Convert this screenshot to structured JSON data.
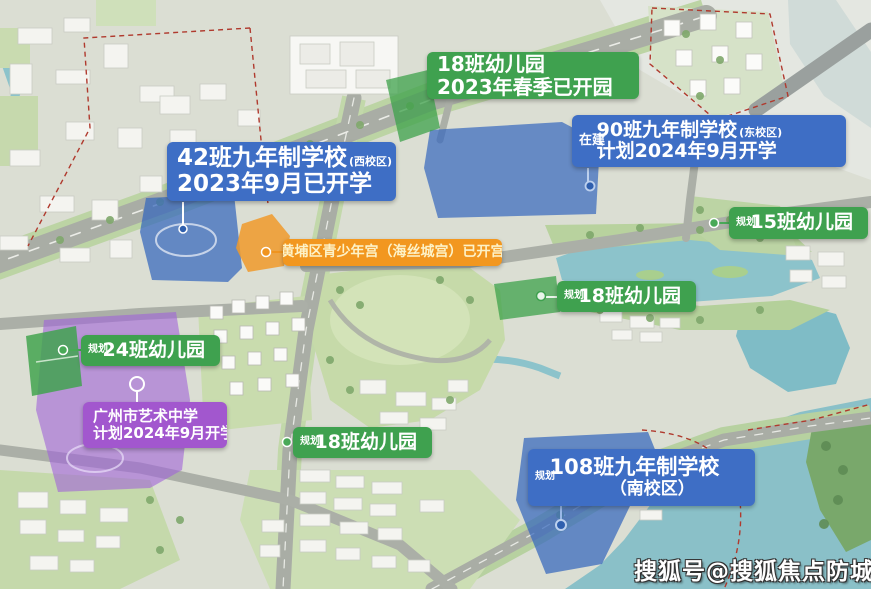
{
  "watermark": "搜狐号@搜狐焦点防城港站",
  "colors": {
    "label_green": "#3fa14f",
    "label_blue": "#3e6ec5",
    "label_orange": "#f2971f",
    "label_purple": "#a257ce",
    "orange_text": "#fdf2c7",
    "zone_blue": "#3566bd",
    "zone_green": "#3da24b",
    "zone_purple": "#a062d8",
    "zone_orange": "#f09a2a",
    "water": "#8cc3cb",
    "park": "#c6daa9",
    "road": "#a9ada5",
    "boundary_red": "#b03a2e"
  },
  "labels": {
    "kg18_top": {
      "line1": "18班幼儿园",
      "line2": "2023年春季已开园"
    },
    "school90": {
      "tag": "在建",
      "line1": "90班九年制学校",
      "line1_small": "(东校区)",
      "line2": "计划2024年9月开学"
    },
    "school42": {
      "line1": "42班九年制学校",
      "line1_small": "(西校区)",
      "line2": "2023年9月已开学"
    },
    "kg15": {
      "tag": "规划",
      "line1": "15班幼儿园"
    },
    "youth_palace": {
      "line1": "黄埔区青少年宫（海丝城宫）已开宫"
    },
    "kg18_mid": {
      "tag": "规划",
      "line1": "18班幼儿园"
    },
    "kg24": {
      "tag": "规划",
      "line1": "24班幼儿园"
    },
    "art_school": {
      "line1": "广州市艺术中学",
      "line2": "计划2024年9月开学"
    },
    "kg18_south": {
      "tag": "规划",
      "line1": "18班幼儿园"
    },
    "school108": {
      "tag": "规划",
      "line1": "108班九年制学校",
      "line2": "（南校区）"
    }
  }
}
